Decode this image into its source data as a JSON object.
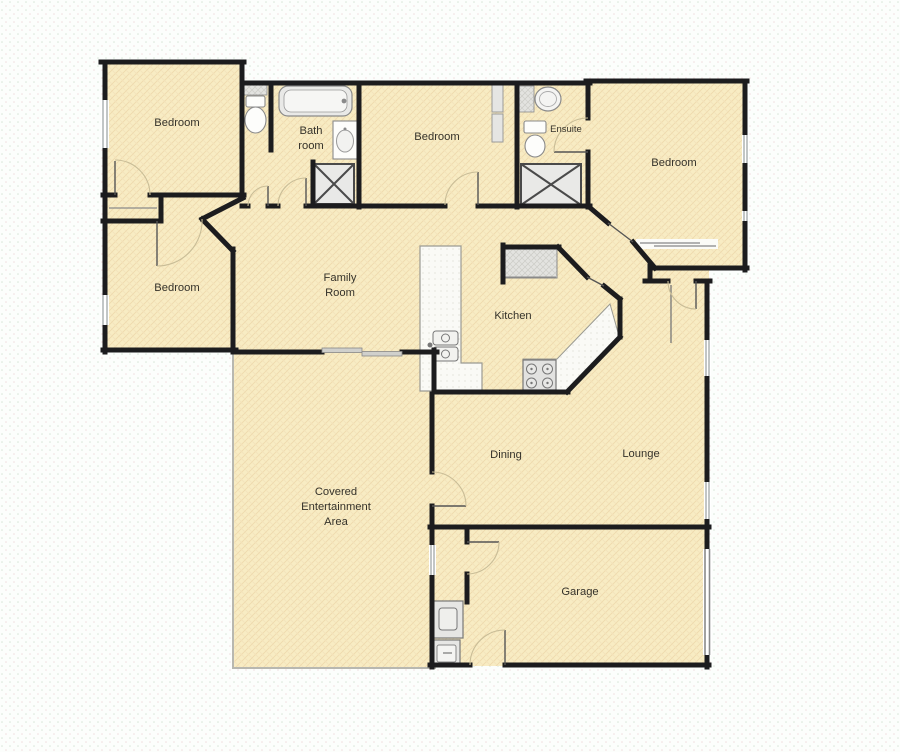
{
  "floorplan": {
    "title": "house-floor-plan",
    "palette": {
      "background": "#fbfdfa",
      "room_fill": "#f8ecc3",
      "wall": "#1c1c1e",
      "fixture_fill": "#ececea",
      "fixture_stroke": "#8a8a8a",
      "window_glaze": "#9aa0a0",
      "door_arc": "#c9bd97",
      "outdoor_border": "#b8b8b0"
    },
    "labels": {
      "bedroom_top_left": "Bedroom",
      "bathroom_line1": "Bath",
      "bathroom_line2": "room",
      "bedroom_top_middle": "Bedroom",
      "ensuite": "Ensuite",
      "bedroom_top_right": "Bedroom",
      "bedroom_left": "Bedroom",
      "family_line1": "Family",
      "family_line2": "Room",
      "kitchen": "Kitchen",
      "dining": "Dining",
      "lounge": "Lounge",
      "covered_line1": "Covered",
      "covered_line2": "Entertainment",
      "covered_line3": "Area",
      "garage": "Garage"
    },
    "fixtures": [
      "toilet-wc",
      "bathtub",
      "bathroom-basin",
      "bathroom-shower",
      "ensuite-basin",
      "ensuite-toilet",
      "ensuite-shower",
      "bedroom2-robe",
      "pantry",
      "kitchen-island-sink",
      "stove-cooktop",
      "kitchen-bench",
      "washing-machine",
      "laundry-tub",
      "garage-door",
      "sliding-door",
      "windows",
      "door-swings"
    ]
  }
}
